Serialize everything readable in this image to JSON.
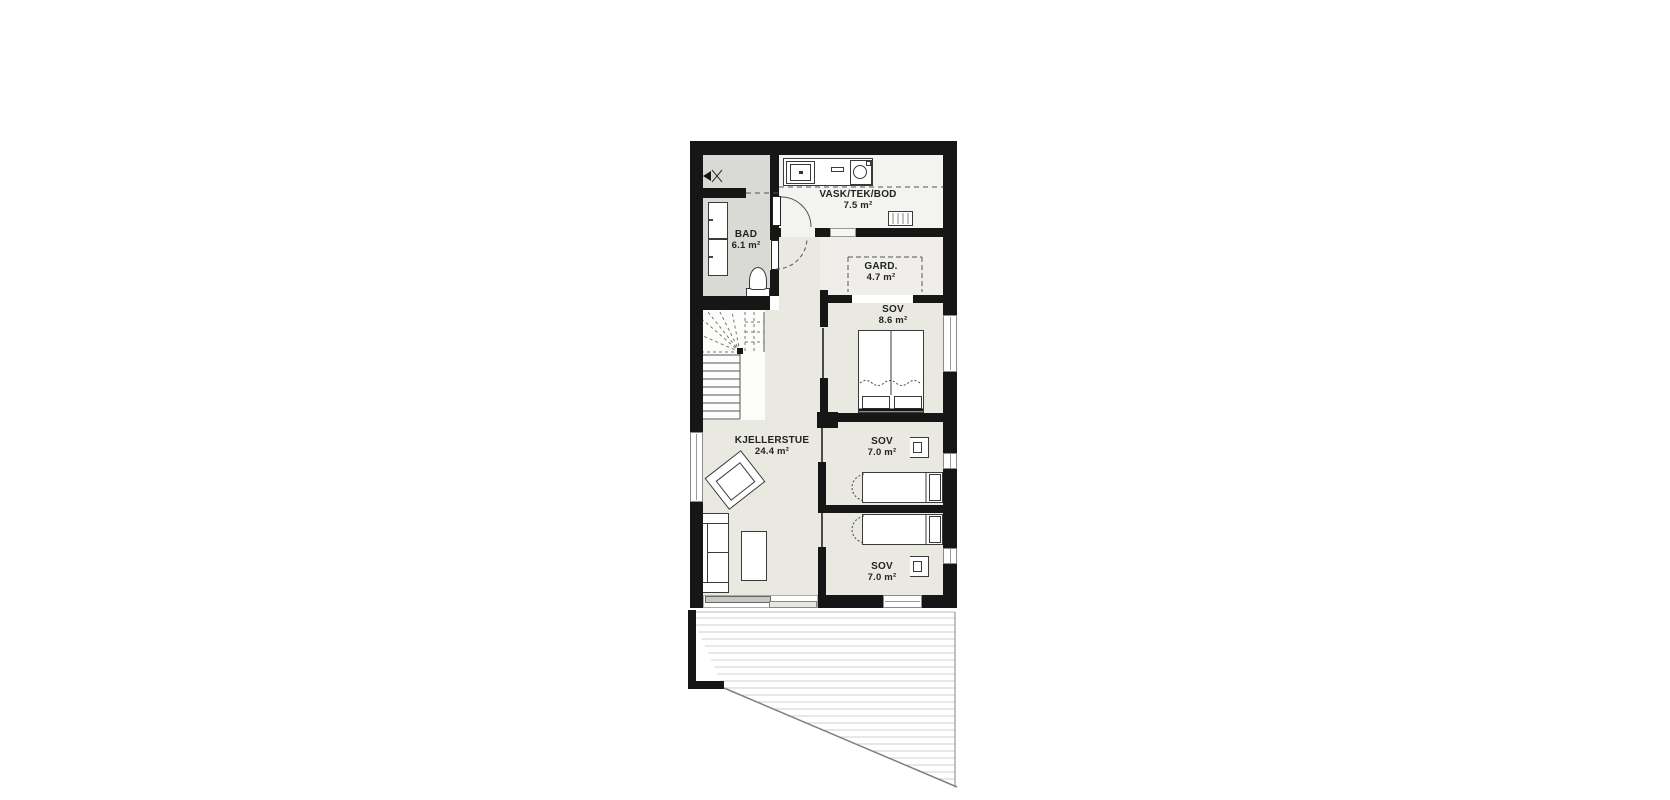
{
  "plan": {
    "type": "floor-plan",
    "language": "Norwegian",
    "rooms": [
      {
        "id": "vask-tek-bod",
        "name": "VASK/TEK/BOD",
        "area": "7.5 m²"
      },
      {
        "id": "bad",
        "name": "BAD",
        "area": "6.1 m²"
      },
      {
        "id": "gard",
        "name": "GARD.",
        "area": "4.7 m²"
      },
      {
        "id": "sov-8-6",
        "name": "SOV",
        "area": "8.6 m²"
      },
      {
        "id": "kjellerstue",
        "name": "KJELLERSTUE",
        "area": "24.4 m²"
      },
      {
        "id": "sov-7-0-a",
        "name": "SOV",
        "area": "7.0 m²"
      },
      {
        "id": "sov-7-0-b",
        "name": "SOV",
        "area": "7.0 m²"
      }
    ],
    "fixtures": [
      "stairs",
      "toilet",
      "vanity-cabinets",
      "washing-machine",
      "sink",
      "counter-appliance",
      "tech-cabinet",
      "wardrobe-dashed",
      "double-bed",
      "single-bed",
      "desk-chair",
      "sofa",
      "armchair",
      "coffee-table",
      "sliding-glass-door",
      "window",
      "terrace-deck",
      "ventilation-valve",
      "door-swing"
    ],
    "colors": {
      "wall": "#161616",
      "floor_main": "#e9e8e1",
      "floor_bath": "#d9d9d6",
      "floor_white": "#f3f3f0",
      "floor_gard": "#efeeea",
      "deck_line": "#d2d2d0",
      "background": "#ffffff",
      "text": "#232323"
    }
  }
}
